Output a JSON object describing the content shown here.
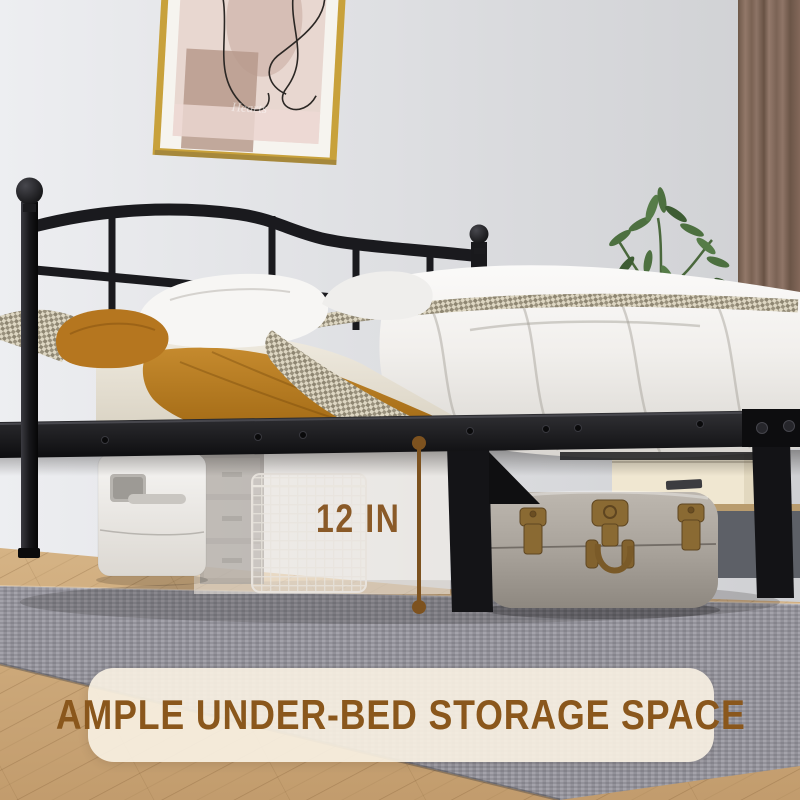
{
  "annotation": {
    "measurement": "12 IN"
  },
  "banner": {
    "text": "AMPLE UNDER-BED STORAGE SPACE"
  },
  "artwork": {
    "caption": "Hearts"
  },
  "colors": {
    "banner_bg": "rgba(247,240,226,0.92)",
    "banner_text": "#8a571c",
    "measure": "#7d521f",
    "measure_text": "#8a5a28",
    "frame_black": "#17171a",
    "orange_sheet": "#b5761f",
    "gold": "#c8a13b",
    "curtain": "#8d7265",
    "plant": "#4d7040",
    "rug": "#93929a",
    "wood": "#cdaa7c",
    "trunk": "#a8a29a",
    "brass": "#8a6a33",
    "duvet": "#f5f4f2",
    "wall": "#e4e5e8"
  }
}
